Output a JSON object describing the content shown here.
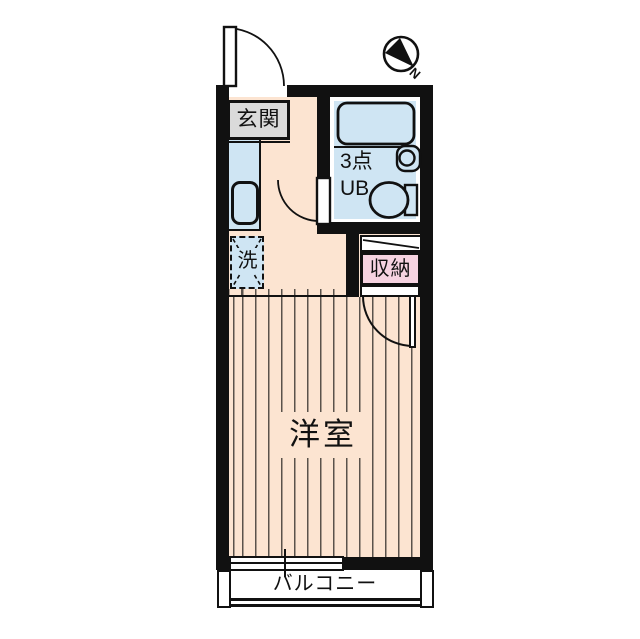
{
  "plan": {
    "title": "1R apartment floor plan",
    "entrance": {
      "label": "玄関"
    },
    "unit_bath": {
      "label_line1": "3点",
      "label_line2": "UB"
    },
    "laundry": {
      "label": "洗"
    },
    "storage": {
      "label": "収納"
    },
    "western_room": {
      "label": "洋室"
    },
    "balcony": {
      "label": "バルコニー"
    },
    "compass": {
      "label": "N"
    }
  },
  "colors": {
    "wall": "#111111",
    "floor_peach": "#fce4d1",
    "wet_area_blue": "#cfe5f3",
    "storage_pink": "#f6d3e1",
    "entrance_gray": "#dadada",
    "floor_stripe": "#5a524b",
    "background": "#ffffff"
  }
}
